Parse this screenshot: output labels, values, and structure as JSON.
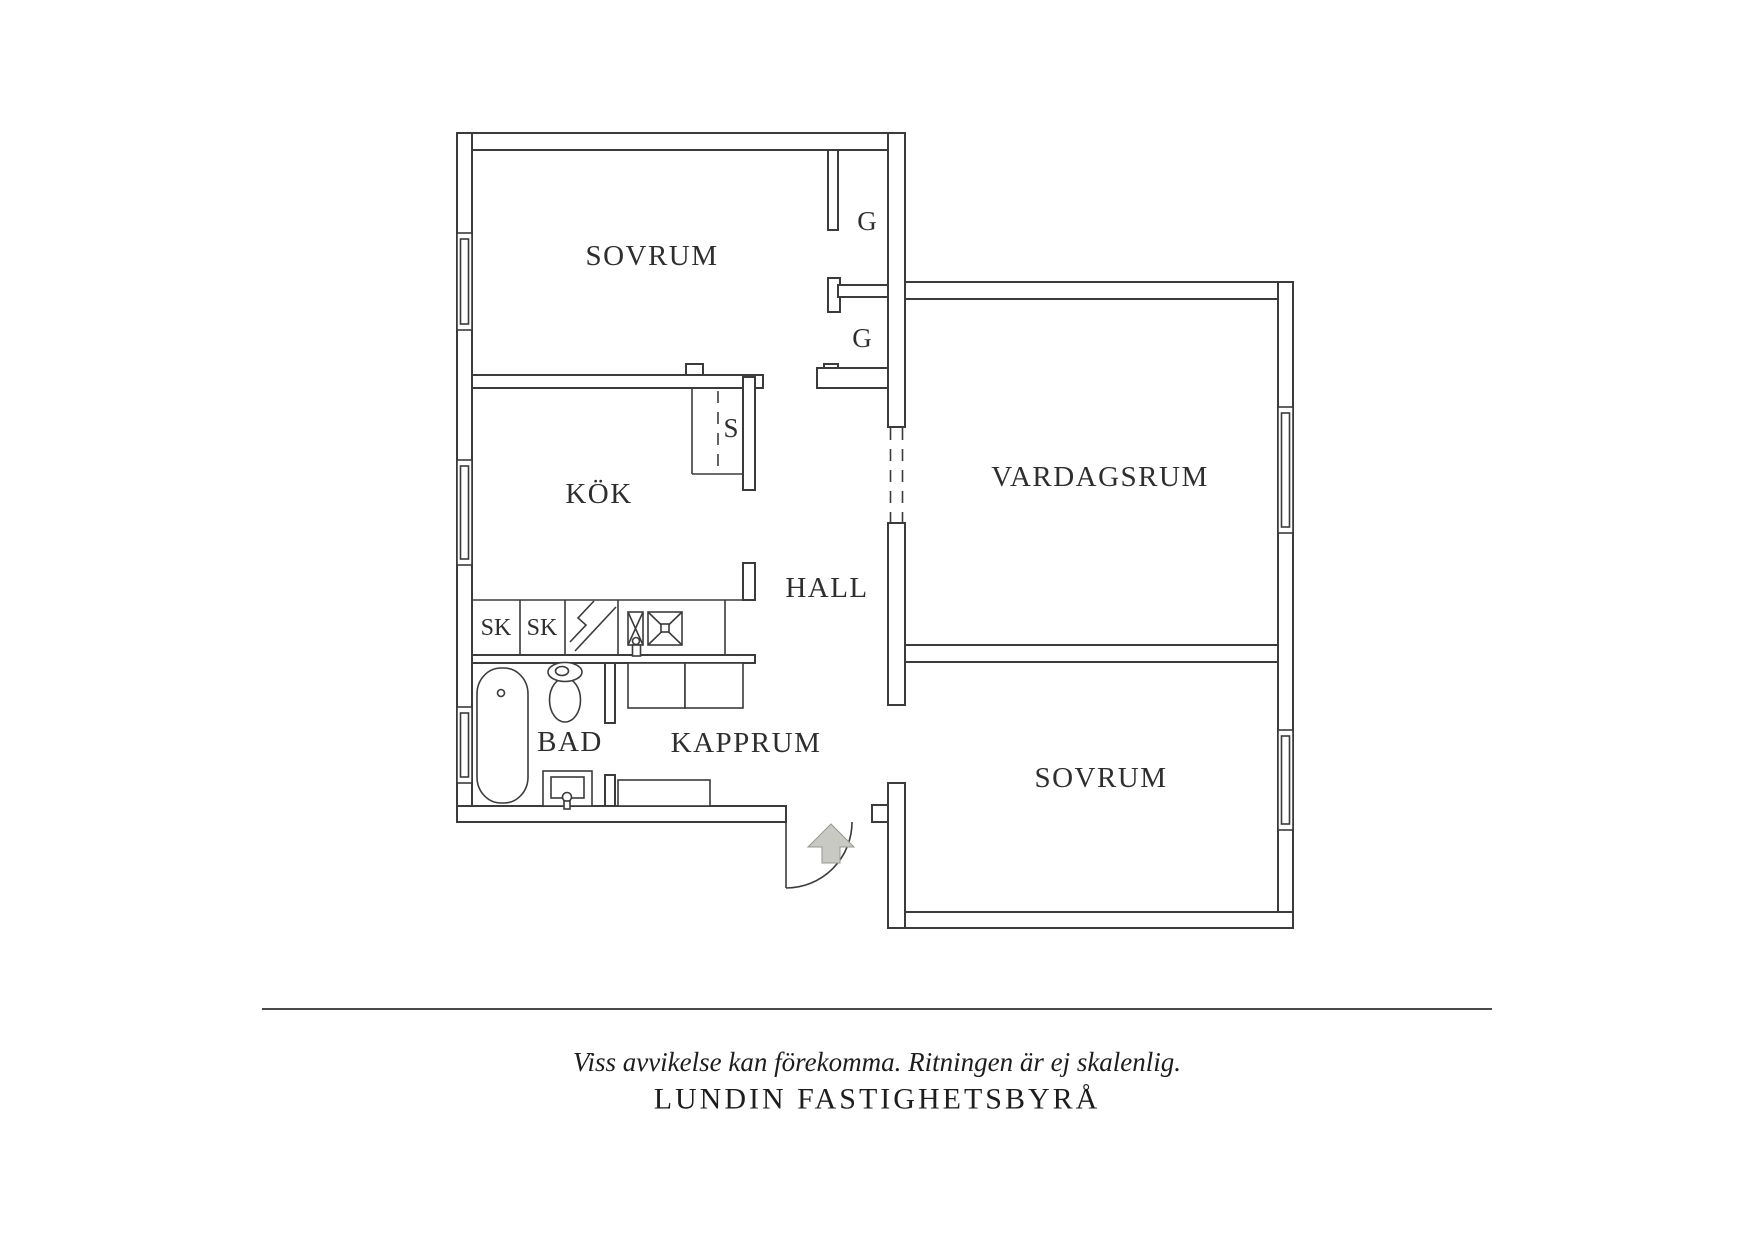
{
  "rooms": {
    "bedroom_top": "SOVRUM",
    "kitchen": "KÖK",
    "living_room": "VARDAGSRUM",
    "hall": "HALL",
    "bathroom": "BAD",
    "cloakroom": "KAPPRUM",
    "bedroom_bottom": "SOVRUM",
    "wardrobe_top": "G",
    "wardrobe_bottom": "G",
    "cleaning_closet": "S",
    "cabinet_1": "SK",
    "cabinet_2": "SK"
  },
  "footer": {
    "disclaimer": "Viss avvikelse kan förekomma. Ritningen är ej skalenlig.",
    "brand": "LUNDIN FASTIGHETSBYRÅ"
  },
  "colors": {
    "line": "#3b3b3b",
    "text": "#2e2e2e",
    "arrow_fill": "#c9c9c4",
    "arrow_stroke": "#979792"
  }
}
